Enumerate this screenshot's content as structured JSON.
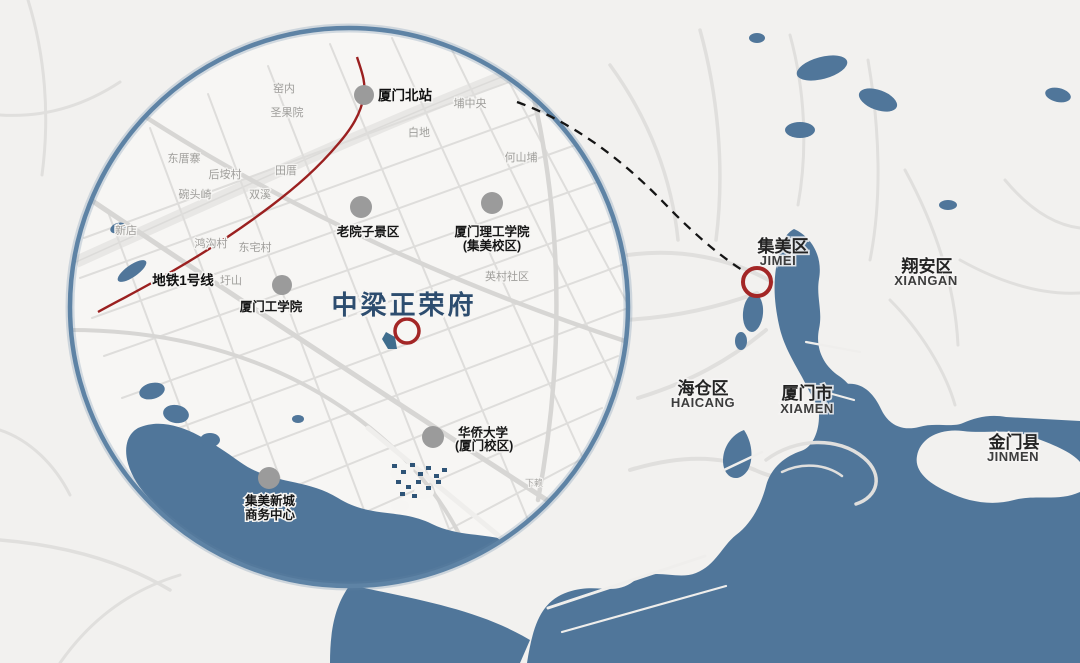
{
  "project": {
    "title": "中梁正荣府"
  },
  "metro": {
    "label": "地铁1号线"
  },
  "pois": [
    {
      "label": "厦门北站"
    },
    {
      "label": "老院子景区"
    },
    {
      "label": "厦门理工学院",
      "label2": "(集美校区)"
    },
    {
      "label": "厦门工学院"
    },
    {
      "label": "华侨大学",
      "label2": "(厦门校区)"
    },
    {
      "label": "集美新城",
      "label2": "商务中心"
    }
  ],
  "districts": [
    {
      "label": "集美区",
      "en": "JIMEI"
    },
    {
      "label": "翔安区",
      "en": "XIANGAN"
    },
    {
      "label": "海仓区",
      "en": "HAICANG"
    },
    {
      "label": "厦门市",
      "en": "XIAMEN"
    },
    {
      "label": "金门县",
      "en": "JINMEN"
    }
  ],
  "villages": [
    "窑内",
    "圣果院",
    "埔中央",
    "白地",
    "何山埔",
    "东厝寨",
    "后垵村",
    "田厝",
    "碗头崎",
    "双溪",
    "新店",
    "鸿沟村",
    "东宅村",
    "圩山",
    "英村社区",
    "下赖"
  ],
  "icons": [
    "poi-dot-icon",
    "project-ring-icon",
    "jimei-ring-icon"
  ],
  "colors": {
    "water": "#50769a",
    "land": "#f2f1ef",
    "metro_line": "#9b2020",
    "marker_ring": "#a32626",
    "magnifier_stroke": "#5e83a5",
    "dashed_connector": "#151515",
    "poi_dot": "#9b9b9b",
    "title": "#2d4d6f"
  }
}
